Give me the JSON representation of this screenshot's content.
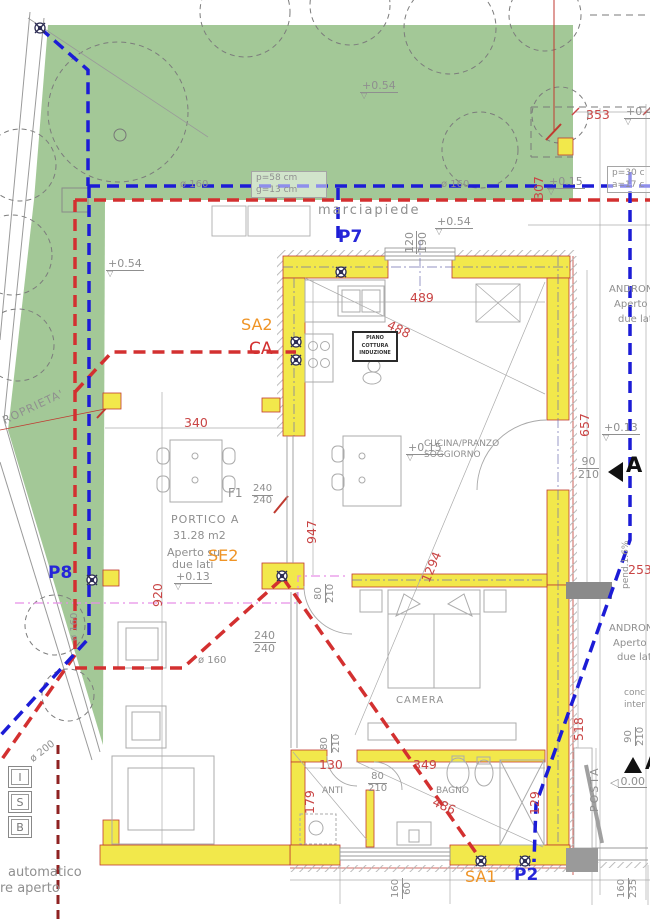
{
  "colors": {
    "garden_green": "#a3c897",
    "wall_yellow": "#f2e84b",
    "pipe_blue": "#1c1cd6",
    "pipe_red": "#d33030",
    "pipe_dark_red": "#8f2222",
    "magenta": "#e78fe7",
    "dim_red": "#c94545",
    "label_gray": "#8f8f8f",
    "accent_orange": "#ef9426",
    "accent_blue": "#2626d8"
  },
  "levels": {
    "l054": "+0.54",
    "l015": "+0.15",
    "l013": "+0.13",
    "l000": "0.00",
    "l04": "+0.4"
  },
  "dims": {
    "d353": "353",
    "d307": "307",
    "d489": "489",
    "d488": "488",
    "d340": "340",
    "d657": "657",
    "d947": "947",
    "d1294": "1294",
    "d920": "920",
    "d130": "130",
    "d349": "349",
    "d486": "486",
    "d179": "179",
    "d129": "129",
    "d518": "518",
    "d253": "253"
  },
  "fracs": {
    "win_top": {
      "num": "120",
      "den": "190"
    },
    "door_right": {
      "num": "90",
      "den": "210"
    },
    "door_andr": {
      "num": "90",
      "den": "210"
    },
    "f1": {
      "num": "240",
      "den": "240"
    },
    "portico": {
      "num": "240",
      "den": "240"
    },
    "door_cam": {
      "num": "80",
      "den": "210"
    },
    "door_anti": {
      "num": "80",
      "den": "210"
    },
    "door_bagno": {
      "num": "80",
      "den": "210"
    },
    "win_bagno": {
      "num": "160",
      "den": "60"
    },
    "win_posta": {
      "num": "160",
      "den": "235"
    }
  },
  "rooms": {
    "cucina1": "CUCINA/PRANZO",
    "cucina2": "SOGGIORNO",
    "camera": "CAMERA",
    "anti": "ANTI",
    "bagno": "BAGNO",
    "portico_name": "PORTICO A",
    "portico_area": "31.28 m2",
    "portico_open1": "Aperto su",
    "portico_open2": "due lati",
    "androne": "ANDRONE",
    "androne_open1": "Aperto",
    "androne_open2": "due lati",
    "marciapiede": "marciapiede",
    "posta": "POSTA",
    "pend": "pend.1.6%",
    "f1": "F1"
  },
  "piano": {
    "l1": "PIANO",
    "l2": "COTTURA",
    "l3": "INDUZIONE"
  },
  "pipes": {
    "p7": "P7",
    "p8": "P8",
    "p2": "P2",
    "sa1": "SA1",
    "sa2": "SA2",
    "se2": "SE2",
    "ca": "CA"
  },
  "diam": {
    "d160": "ø 160",
    "d200": "ø 200"
  },
  "boxes": {
    "b1l1": "p=58 cm",
    "b1l2": "g=13 cm",
    "b2l1": "p=30 c",
    "b2l2": "a=17 c"
  },
  "isb": [
    "I",
    "S",
    "B"
  ],
  "notes": {
    "auto1": "automatico",
    "auto2": "re aperto",
    "conc1": "conc",
    "conc2": "inter",
    "proprieta": "ROPRIETA'"
  },
  "section": {
    "letter": "A"
  }
}
